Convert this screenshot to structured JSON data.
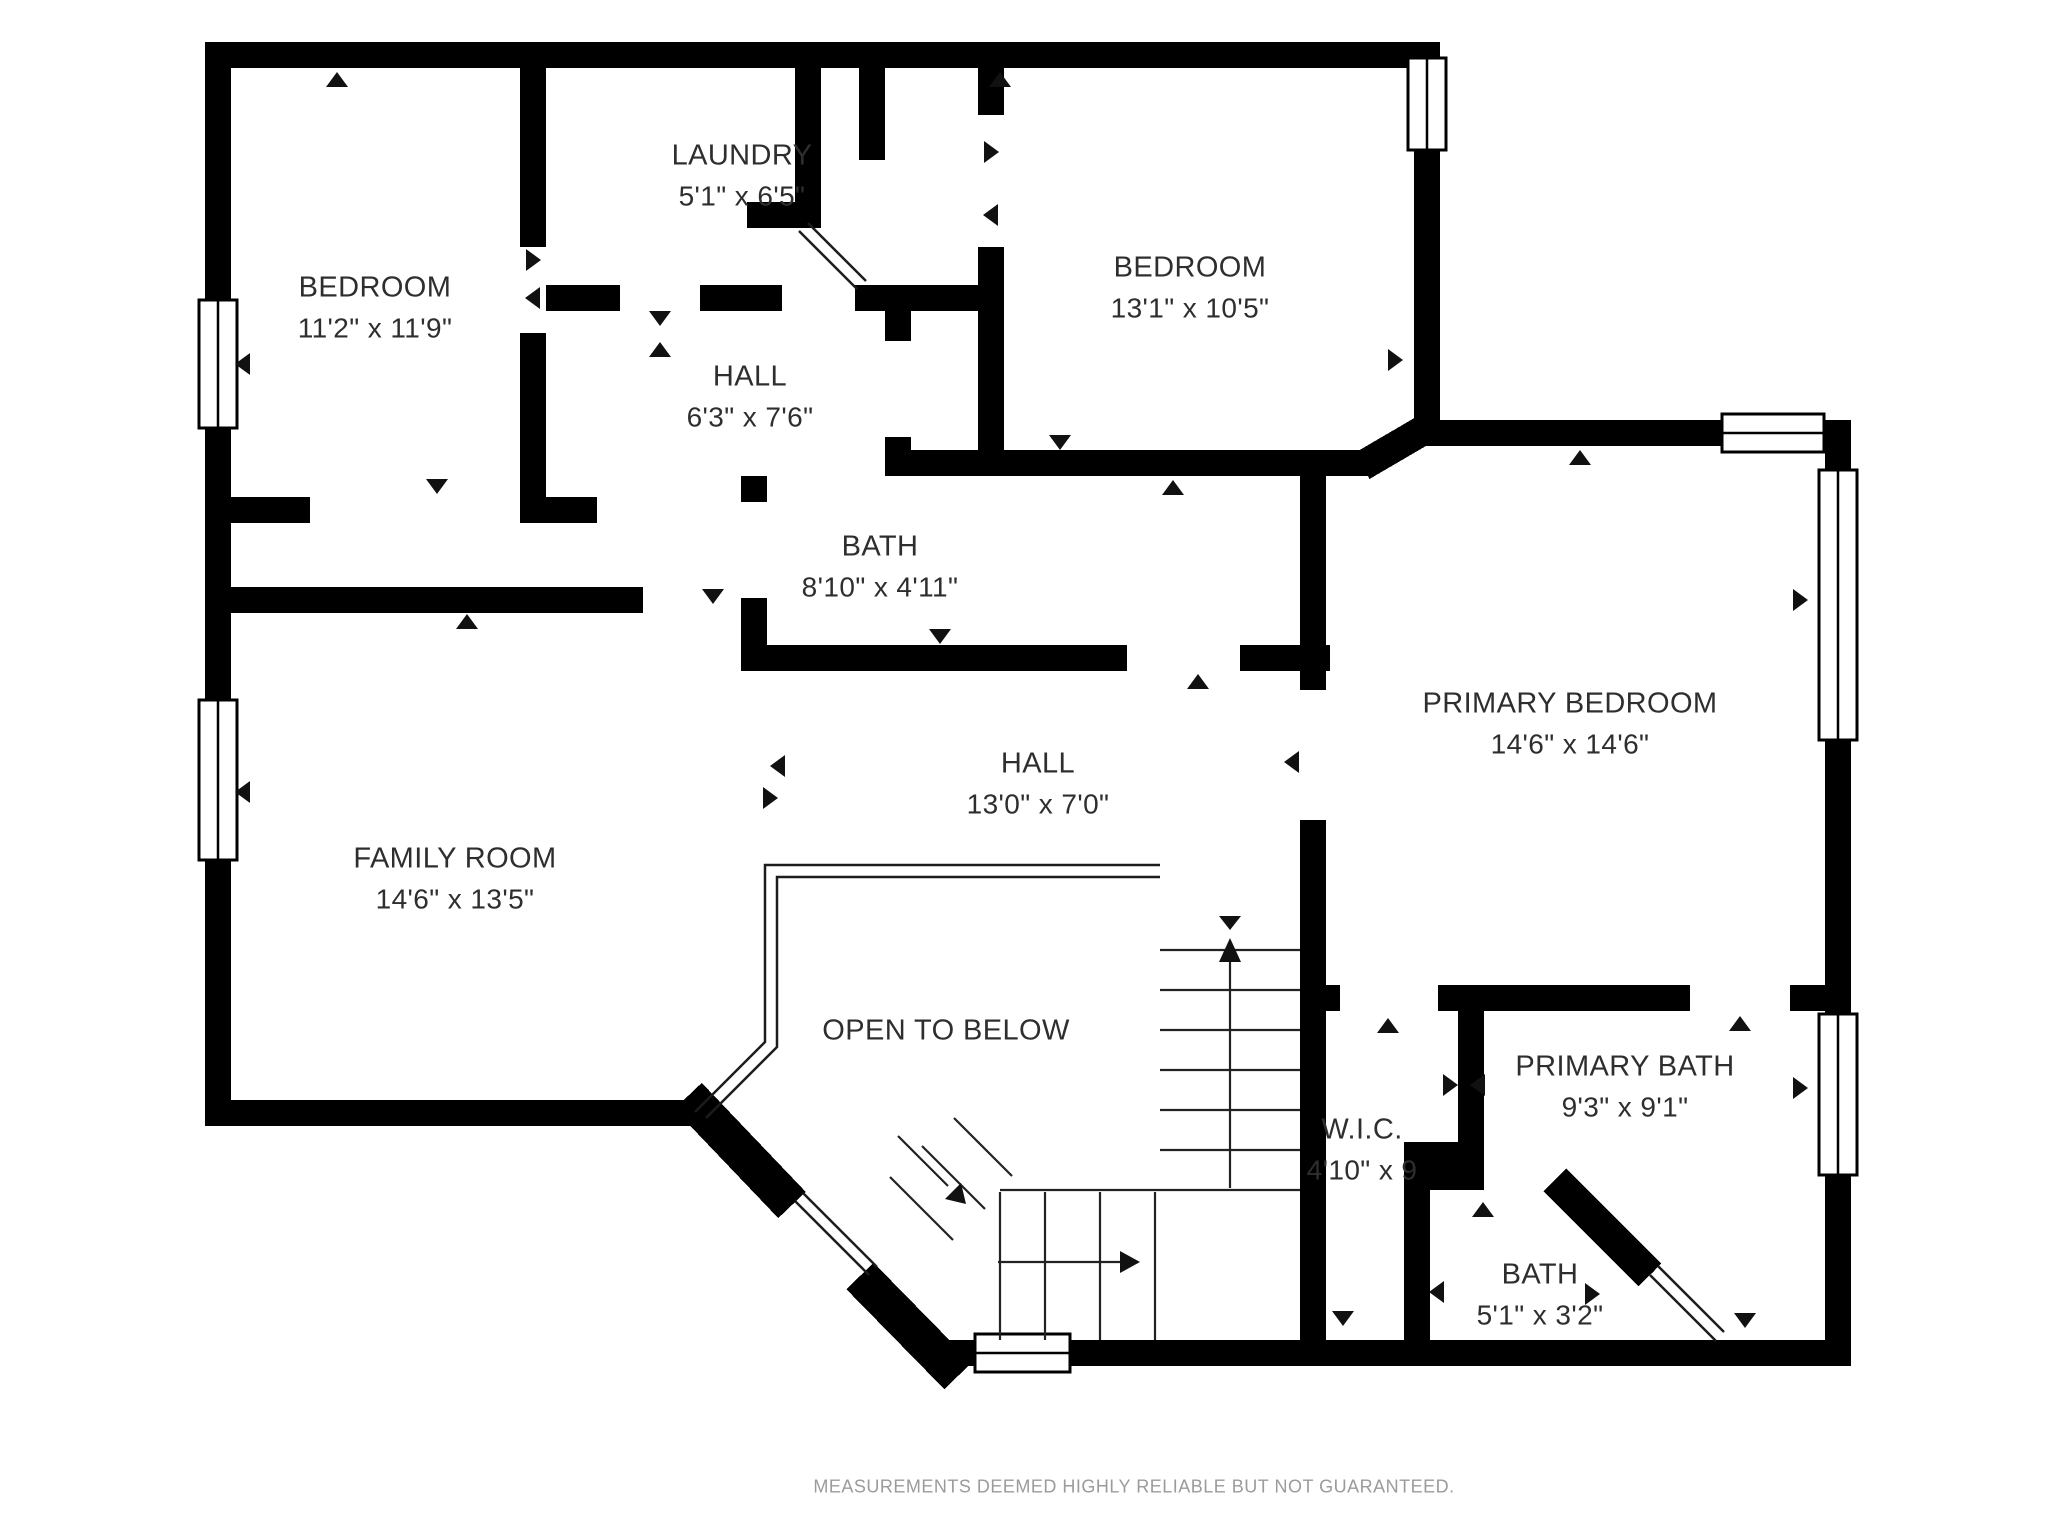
{
  "plan": {
    "footer": "MEASUREMENTS DEEMED HIGHLY RELIABLE BUT NOT GUARANTEED.",
    "colors": {
      "background": "#ffffff",
      "walls": "#000000",
      "label_text": "#2e2e2e",
      "footer_text": "#9b9b9b"
    },
    "rooms": [
      {
        "id": "bedroom-1",
        "name": "BEDROOM",
        "dims": "11'2\" x 11'9\""
      },
      {
        "id": "laundry",
        "name": "LAUNDRY",
        "dims": "5'1\" x 6'5\""
      },
      {
        "id": "hall-upper",
        "name": "HALL",
        "dims": "6'3\" x 7'6\""
      },
      {
        "id": "bedroom-2",
        "name": "BEDROOM",
        "dims": "13'1\" x 10'5\""
      },
      {
        "id": "bath-hall",
        "name": "BATH",
        "dims": "8'10\" x 4'11\""
      },
      {
        "id": "primary-bedroom",
        "name": "PRIMARY BEDROOM",
        "dims": "14'6\" x 14'6\""
      },
      {
        "id": "hall-main",
        "name": "HALL",
        "dims": "13'0\" x 7'0\""
      },
      {
        "id": "family-room",
        "name": "FAMILY ROOM",
        "dims": "14'6\" x 13'5\""
      },
      {
        "id": "open-to-below",
        "name": "OPEN TO BELOW",
        "dims": ""
      },
      {
        "id": "wic",
        "name": "W.I.C.",
        "dims": "4'10\" x 9"
      },
      {
        "id": "primary-bath",
        "name": "PRIMARY BATH",
        "dims": "9'3\" x 9'1\""
      },
      {
        "id": "bath-2",
        "name": "BATH",
        "dims": "5'1\" x 3'2\""
      }
    ]
  }
}
